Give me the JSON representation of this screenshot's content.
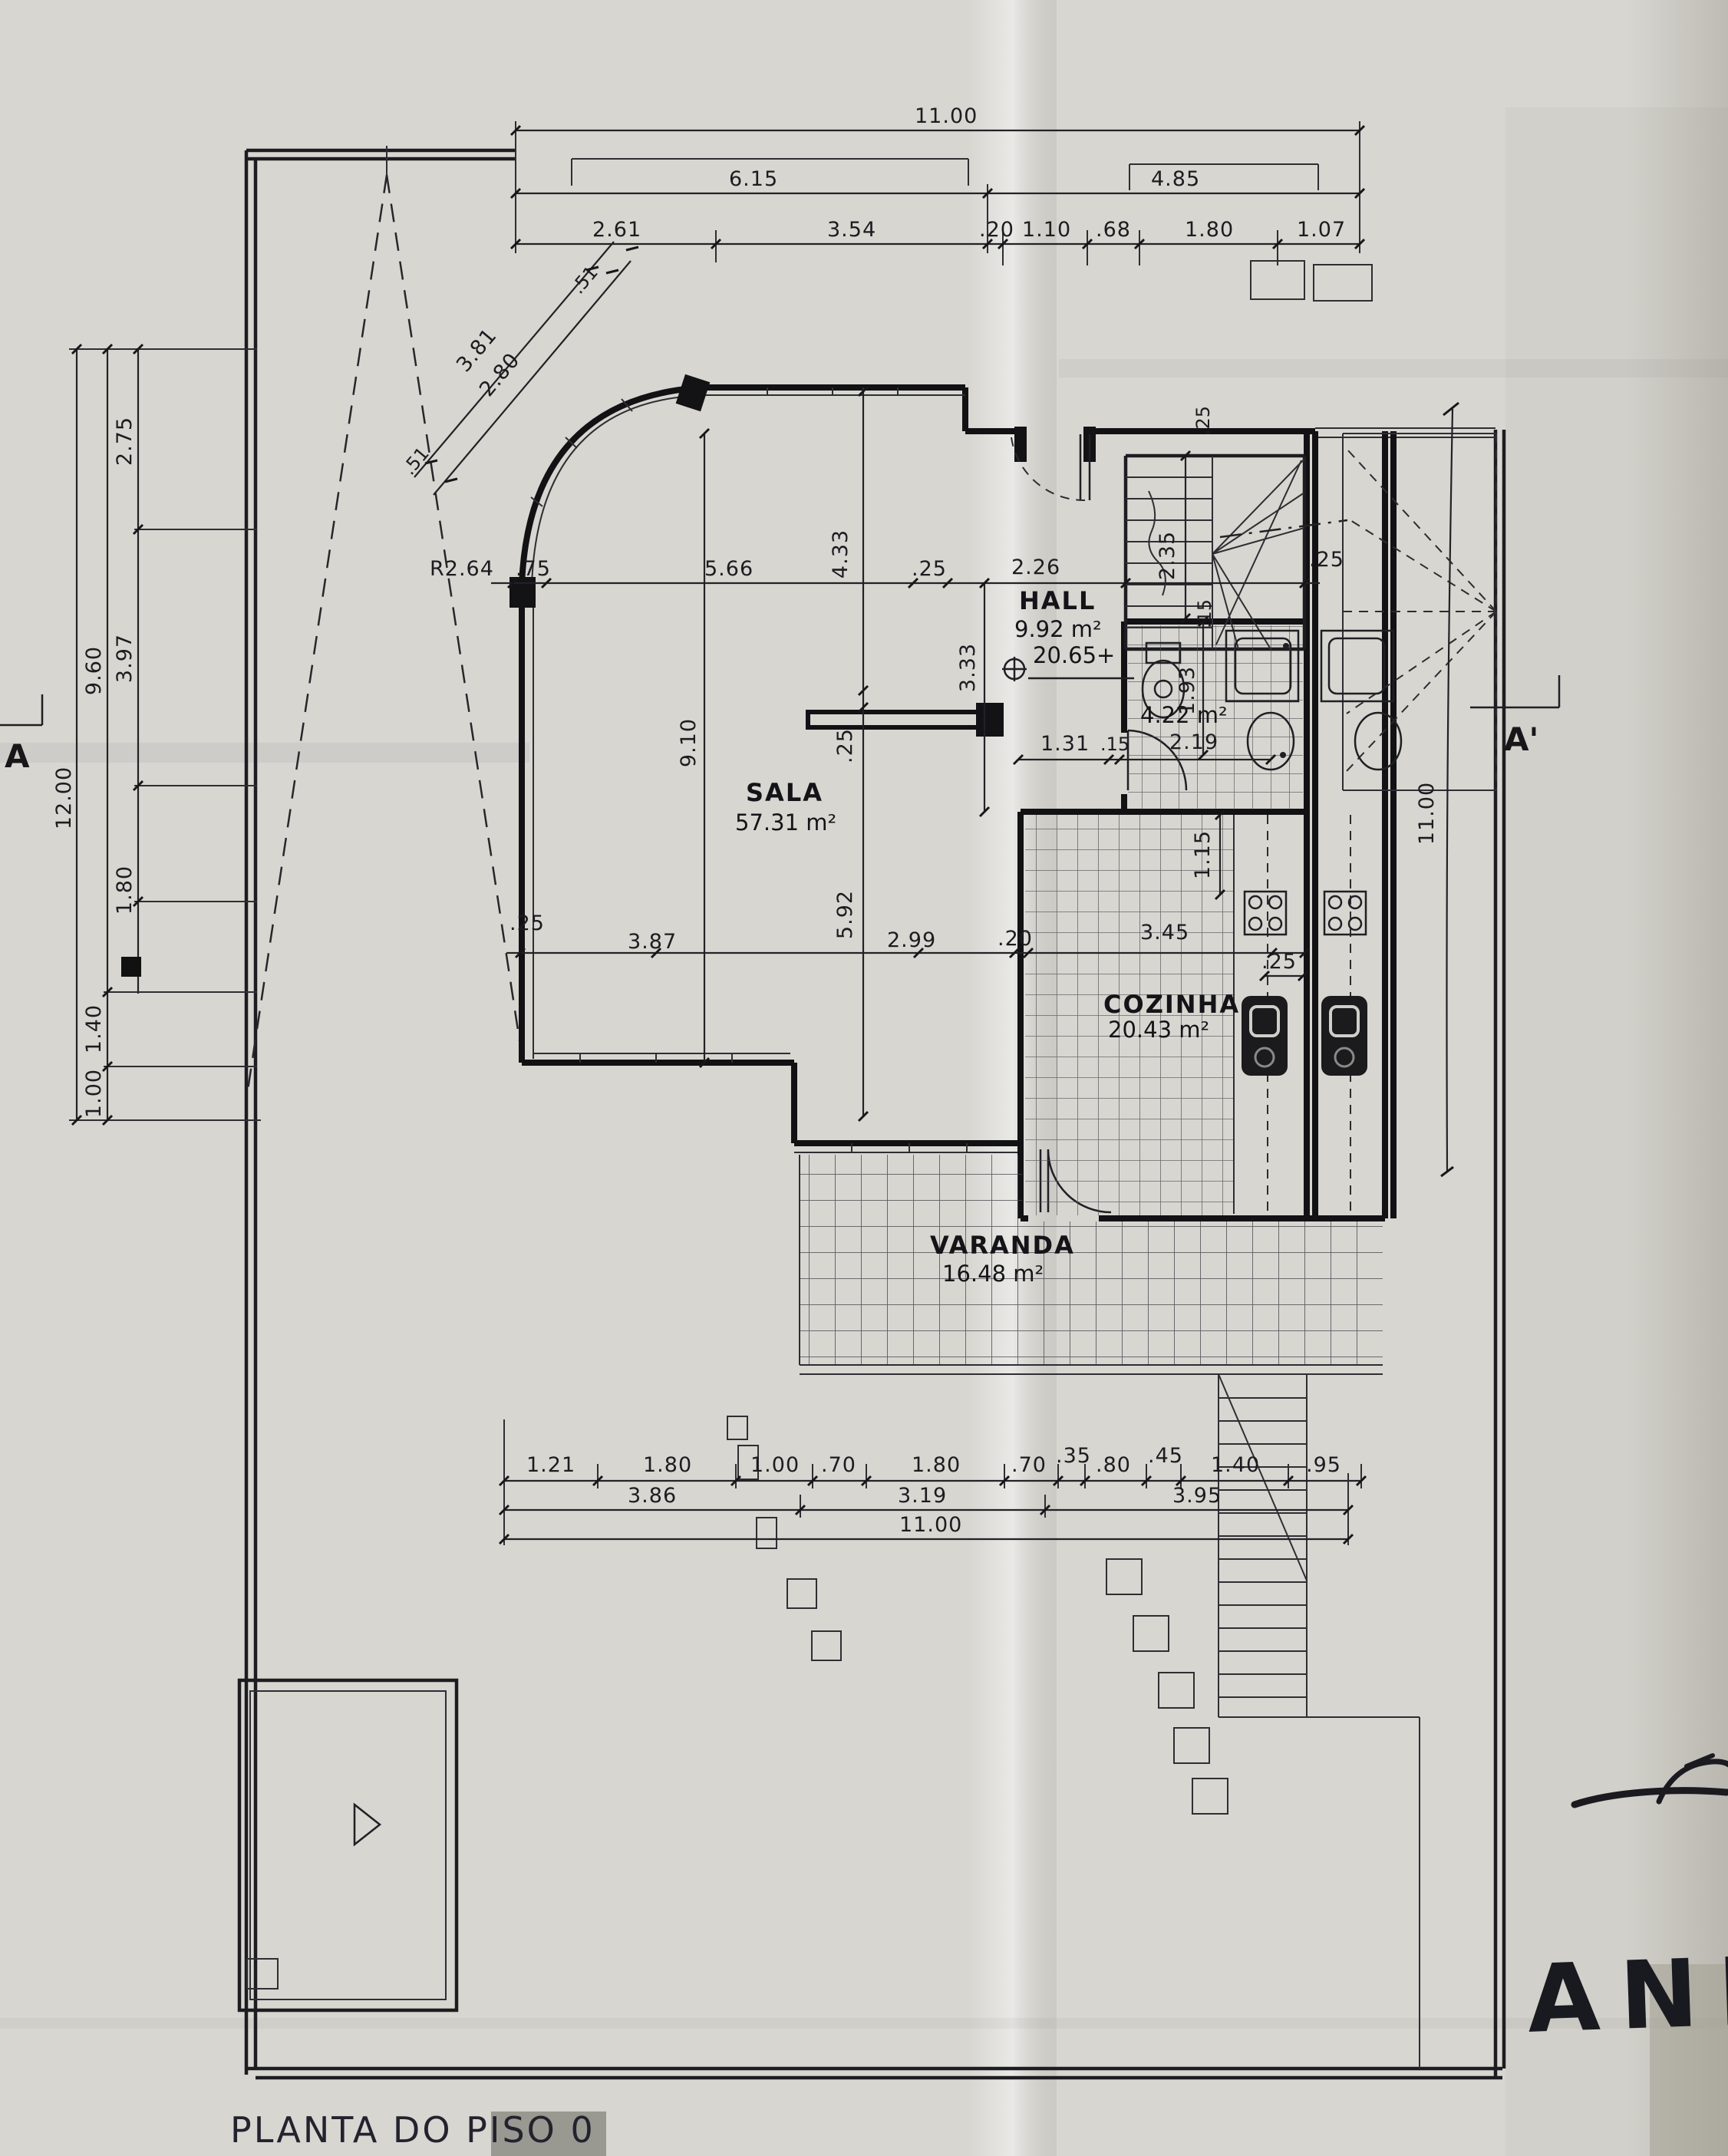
{
  "plan": {
    "title": "PLANTA DO PISO 0",
    "handwritten_note": "ANEXO",
    "level_marker": "20.65+",
    "section": {
      "left": "A",
      "right": "A'"
    },
    "rooms": {
      "hall": {
        "name": "HALL",
        "area": "9.92 m²"
      },
      "sala": {
        "name": "SALA",
        "area": "57.31 m²"
      },
      "cozinha": {
        "name": "COZINHA",
        "area": "20.43 m²"
      },
      "varanda": {
        "name": "VARANDA",
        "area": "16.48 m²"
      },
      "wc": {
        "area": "4.22 m²"
      }
    },
    "dims": {
      "top1": "11.00",
      "top2": [
        "6.15",
        "4.85"
      ],
      "top3": [
        "2.61",
        "3.54",
        ".20",
        "1.10",
        ".68",
        "1.80",
        "1.07"
      ],
      "left_outer": "12.00",
      "left_mid": [
        "9.60",
        "1.40",
        "1.00"
      ],
      "left_inner": [
        "2.75",
        "3.97",
        "1.80"
      ],
      "diag": {
        "a": "3.81",
        "b": "2.80",
        "c": ".51",
        "d": ".51"
      },
      "right": "11.00",
      "bottom1": [
        "1.21",
        "1.80",
        "1.00",
        ".70",
        "1.80",
        ".70",
        ".35",
        ".80",
        ".45",
        "1.40",
        ".95"
      ],
      "bottom2": [
        "3.86",
        "3.19",
        "3.95"
      ],
      "bottom3": "11.00",
      "interior": {
        "radius": "R2.64",
        "w75": ".75",
        "w566": "5.66",
        "w433": "4.33",
        "w25a": ".25",
        "w226": "2.26",
        "h333": "3.33",
        "h910": "9.10",
        "h25": ".25",
        "h592": "5.92",
        "stair_h": "2.35",
        "stair15": ".15",
        "stair25": ".25",
        "top25": ".25",
        "b131": "1.31",
        "b15": ".15",
        "b219": "2.19",
        "b193": "1.93",
        "b115": "1.15",
        "m25a": ".25",
        "m387": "3.87",
        "m299": "2.99",
        "m20": ".20",
        "m345": "3.45",
        "m25b": ".25"
      }
    }
  }
}
